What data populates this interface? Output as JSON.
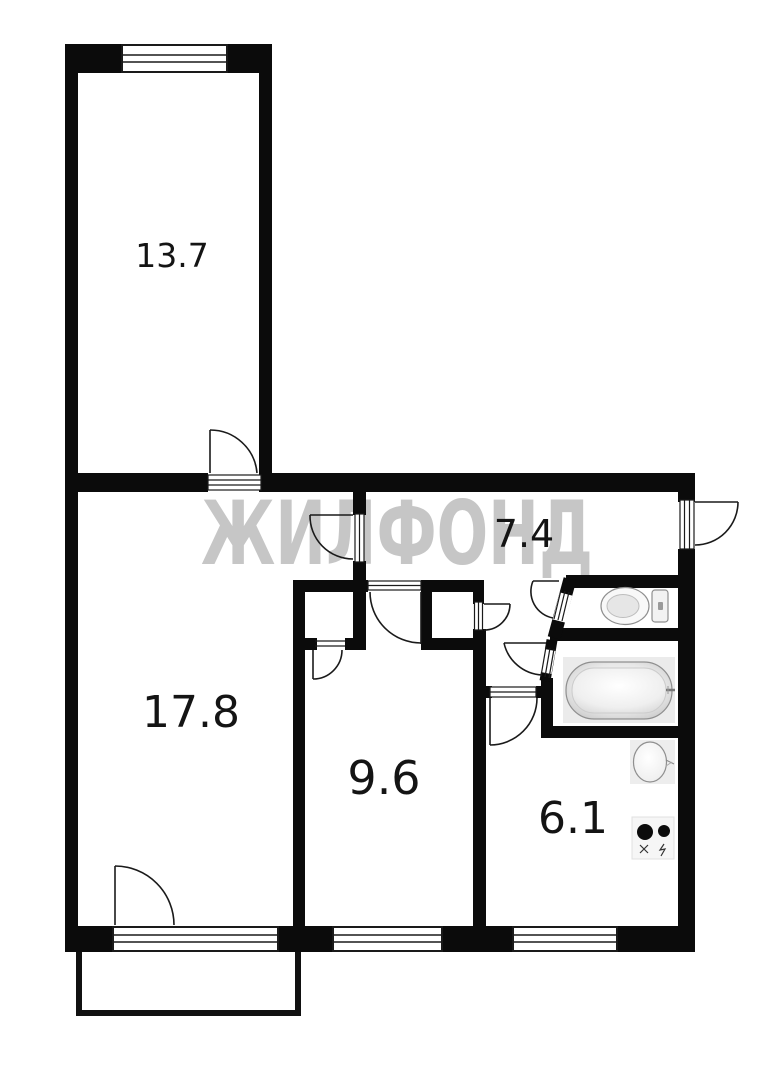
{
  "watermark": {
    "text": "ЖИЛФОНД"
  },
  "colors": {
    "wall": "#0b0b0b",
    "watermark": "#c6c6c6",
    "label": "#141414",
    "fixture_stroke": "#8f8f8f"
  },
  "rooms": [
    {
      "name": "bedroom-top",
      "label": "13.7"
    },
    {
      "name": "living-room",
      "label": "17.8"
    },
    {
      "name": "bedroom-middle",
      "label": "9.6"
    },
    {
      "name": "hallway",
      "label": "7.4"
    },
    {
      "name": "kitchen",
      "label": "6.1"
    }
  ],
  "fixtures": [
    {
      "name": "toilet"
    },
    {
      "name": "bathtub"
    },
    {
      "name": "kitchen-sink"
    },
    {
      "name": "stove"
    }
  ]
}
